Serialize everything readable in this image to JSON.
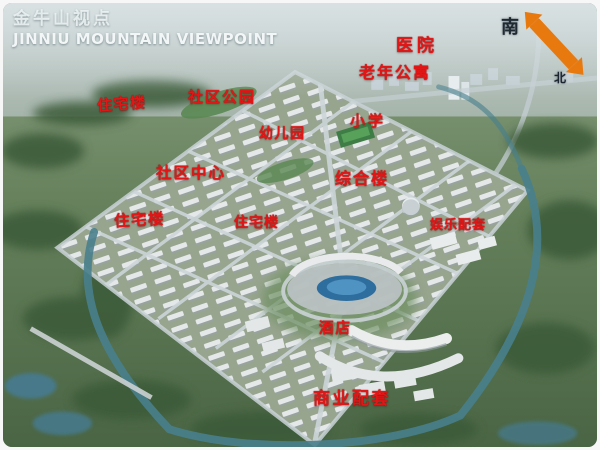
{
  "header": {
    "title_zh": "金牛山视点",
    "title_en": "JINNIU MOUNTAIN VIEWPOINT"
  },
  "compass": {
    "south_label": "南",
    "north_label": "北",
    "arrow_icon": "double-headed-arrow",
    "arrow_color": "#e8790f"
  },
  "map": {
    "type": "aerial-masterplan-rendering",
    "label_color": "#e01717",
    "labels": [
      {
        "id": "hospital",
        "text": "医院"
      },
      {
        "id": "senior-apartments",
        "text": "老年公寓"
      },
      {
        "id": "residential-west",
        "text": "住宅楼"
      },
      {
        "id": "community-park",
        "text": "社区公园"
      },
      {
        "id": "kindergarten",
        "text": "幼儿园"
      },
      {
        "id": "primary-school",
        "text": "小学"
      },
      {
        "id": "community-center",
        "text": "社区中心"
      },
      {
        "id": "complex-building",
        "text": "综合楼"
      },
      {
        "id": "residential-southwest",
        "text": "住宅楼"
      },
      {
        "id": "residential-central",
        "text": "住宅楼"
      },
      {
        "id": "entertainment-facilities",
        "text": "娱乐配套"
      },
      {
        "id": "hotel",
        "text": "酒店"
      },
      {
        "id": "commercial-facilities",
        "text": "商业配套"
      }
    ]
  }
}
